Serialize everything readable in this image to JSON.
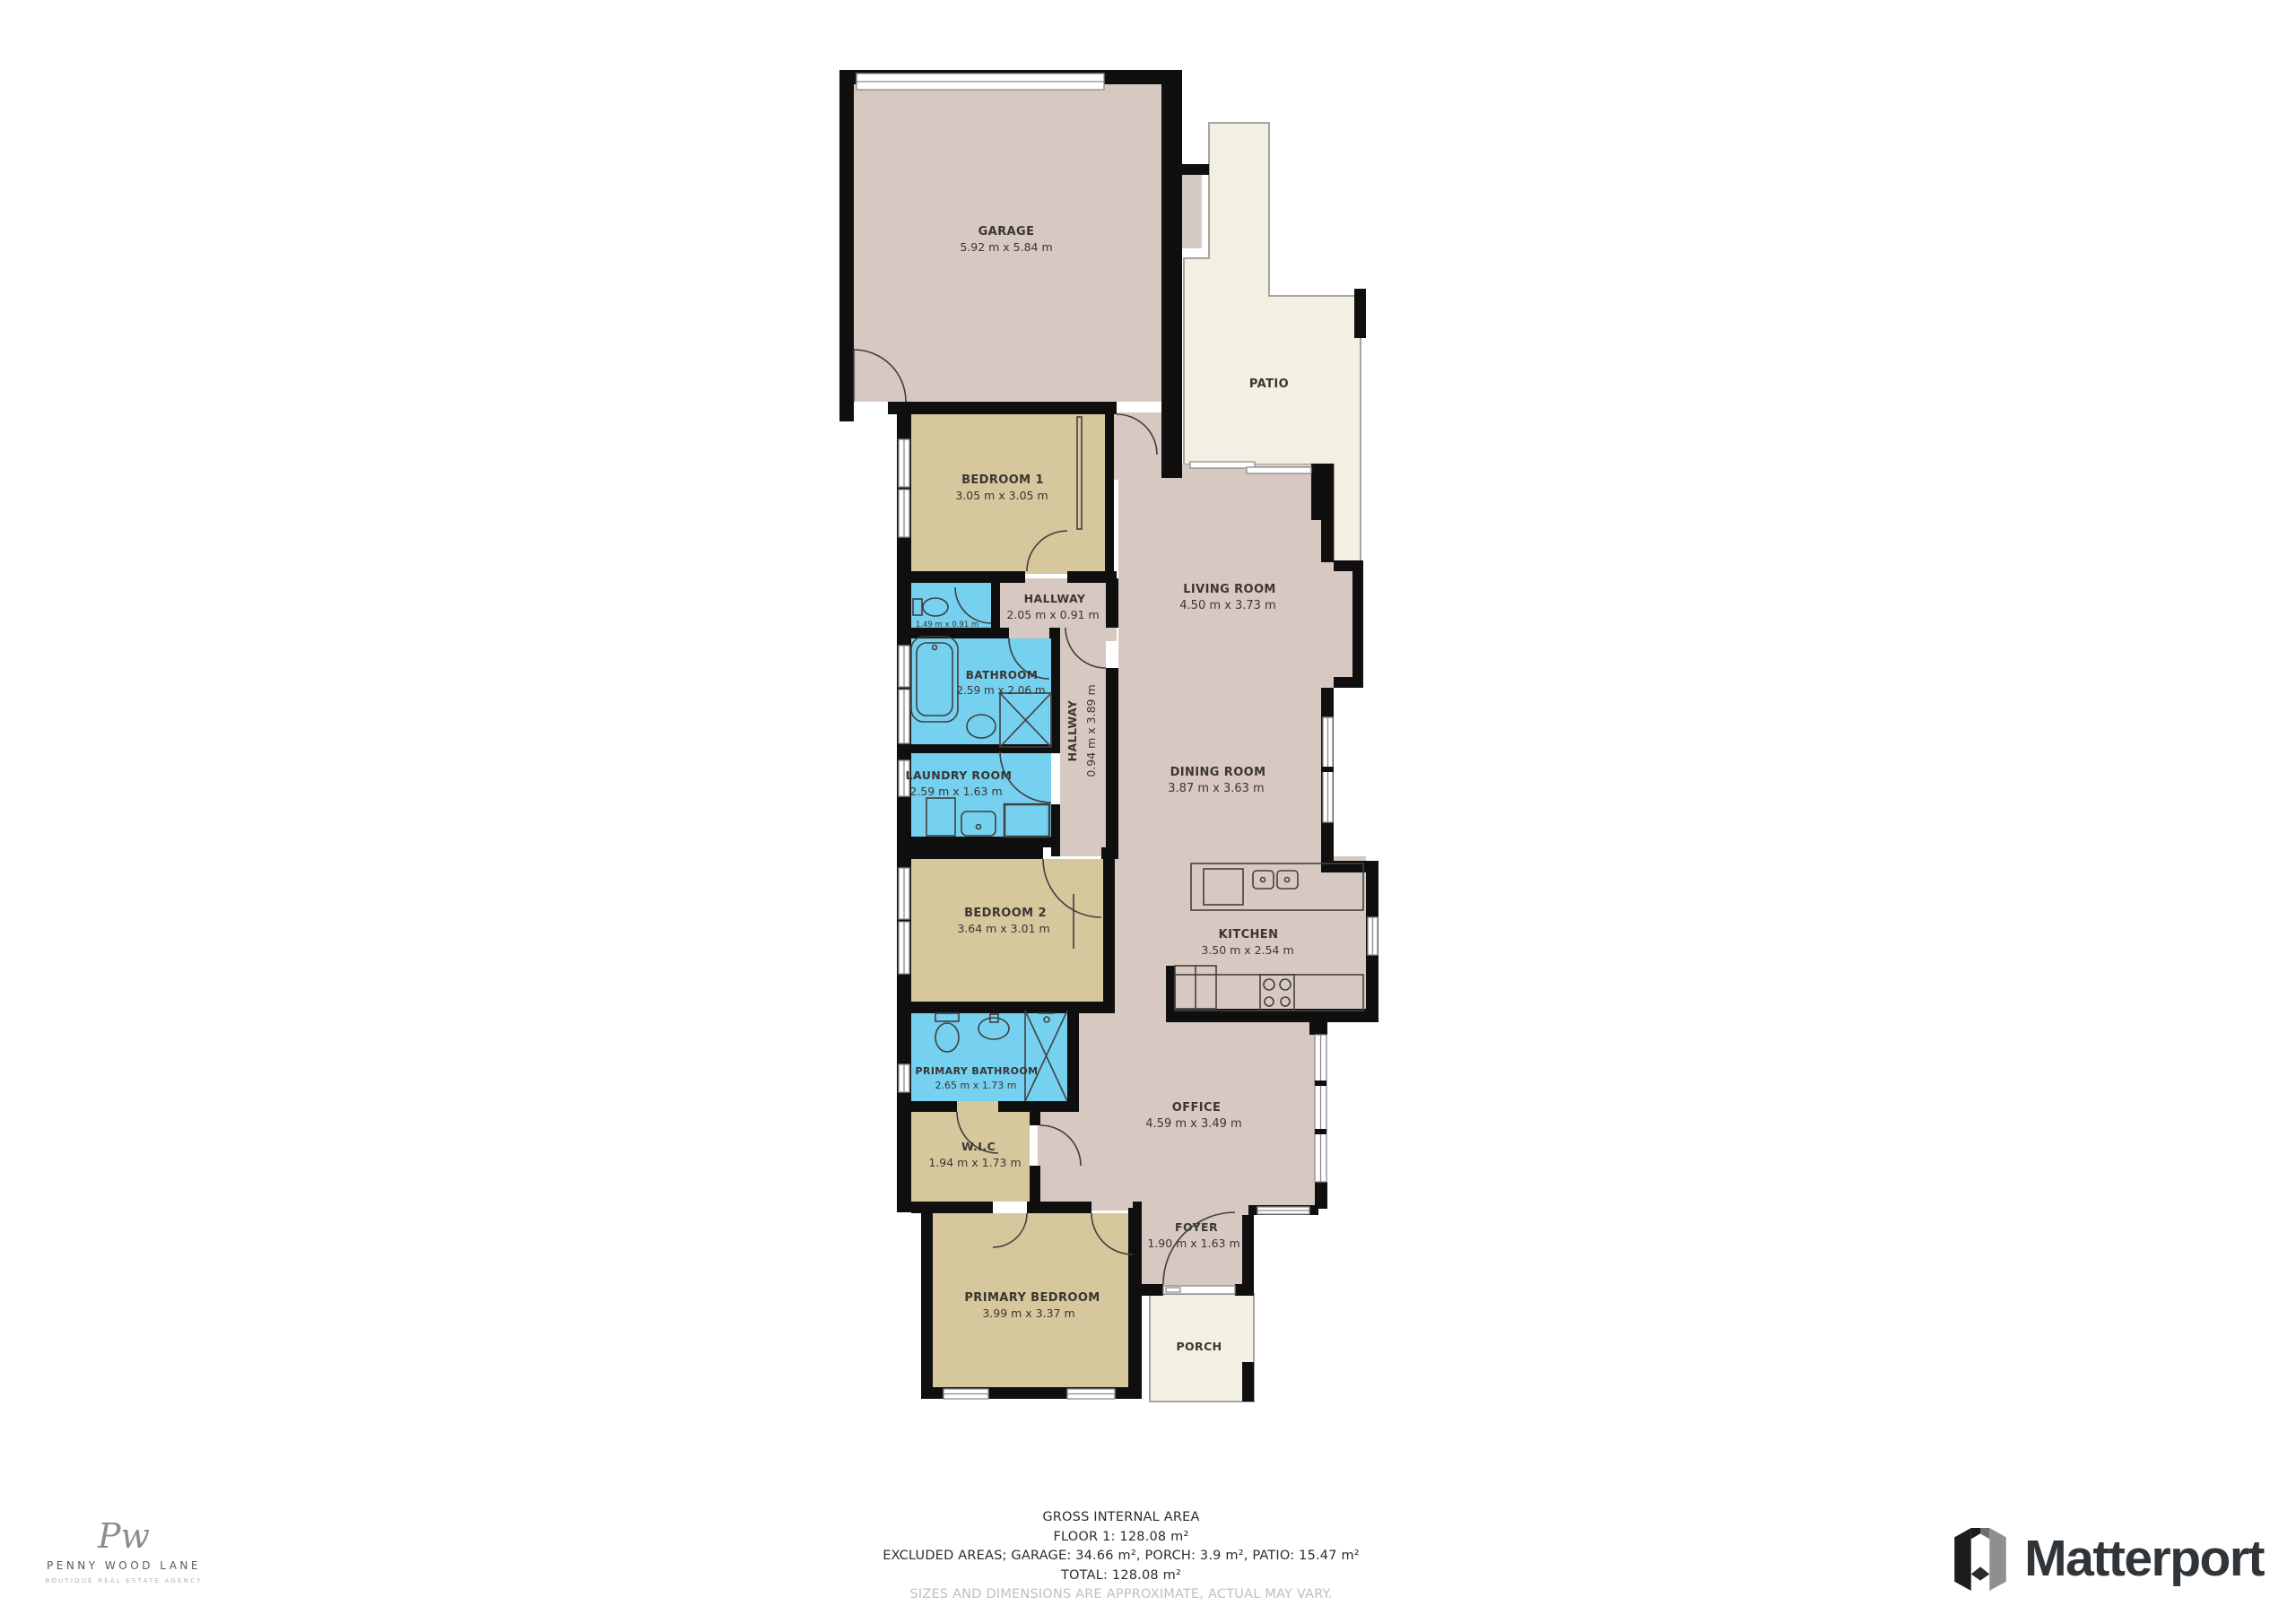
{
  "rooms": {
    "garage": {
      "name": "GARAGE",
      "dims": "5.92 m x 5.84 m"
    },
    "patio": {
      "name": "PATIO",
      "dims": ""
    },
    "bedroom1": {
      "name": "BEDROOM 1",
      "dims": "3.05 m x 3.05 m"
    },
    "hallway_h": {
      "name": "HALLWAY",
      "dims": "2.05 m x 0.91 m"
    },
    "wc": {
      "name": "",
      "dims": "1.49 m x 0.91 m"
    },
    "bathroom": {
      "name": "BATHROOM",
      "dims": "2.59 m x 2.06 m"
    },
    "hallway_v": {
      "name": "HALLWAY",
      "dims": "0.94 m x 3.89 m"
    },
    "living": {
      "name": "LIVING ROOM",
      "dims": "4.50 m x 3.73 m"
    },
    "laundry": {
      "name": "LAUNDRY ROOM",
      "dims": "2.59 m x 1.63 m"
    },
    "dining": {
      "name": "DINING ROOM",
      "dims": "3.87 m x 3.63 m"
    },
    "bedroom2": {
      "name": "BEDROOM 2",
      "dims": "3.64 m x 3.01 m"
    },
    "kitchen": {
      "name": "KITCHEN",
      "dims": "3.50 m x 2.54 m"
    },
    "primary_bath": {
      "name": "PRIMARY BATHROOM",
      "dims": "2.65 m x 1.73 m"
    },
    "wic": {
      "name": "W.I.C",
      "dims": "1.94 m x 1.73 m"
    },
    "office": {
      "name": "OFFICE",
      "dims": "4.59 m x 3.49 m"
    },
    "foyer": {
      "name": "FOYER",
      "dims": "1.90 m x 1.63 m"
    },
    "primary_bedroom": {
      "name": "PRIMARY BEDROOM",
      "dims": "3.99 m x 3.37 m"
    },
    "porch": {
      "name": "PORCH",
      "dims": ""
    }
  },
  "footer": {
    "line1": "GROSS INTERNAL AREA",
    "line2": "FLOOR 1: 128.08 m²",
    "line3": "EXCLUDED AREAS; GARAGE: 34.66 m², PORCH: 3.9 m², PATIO: 15.47 m²",
    "line4": "TOTAL: 128.08 m²",
    "line5": "SIZES AND DIMENSIONS ARE APPROXIMATE, ACTUAL MAY VARY."
  },
  "agency": {
    "monogram": "Pw",
    "name": "PENNY WOOD LANE",
    "tagline": "BOUTIQUE REAL ESTATE AGENCY"
  },
  "matterport": {
    "wordmark": "Matterport"
  },
  "colors": {
    "wall": "#0f0f0f",
    "interior_taupe": "#d7c9c1",
    "bedroom_tan": "#d7c79d",
    "bath_blue": "#76d0f0",
    "outdoor_cream": "#f3efe2",
    "label_text": "#3a3631",
    "disclaimer_gray": "#bfbfbf",
    "logo_dark": "#30353a"
  }
}
